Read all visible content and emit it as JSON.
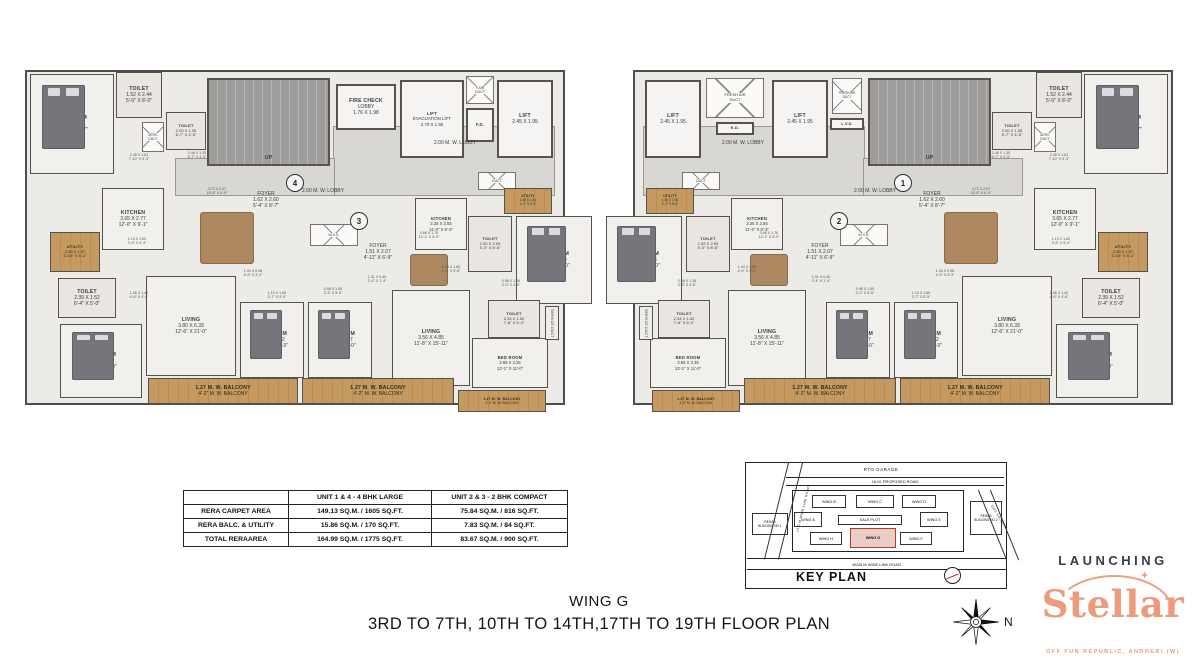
{
  "titles": {
    "wing": "WING G",
    "floors": "3RD TO 7TH, 10TH TO 14TH,17TH TO 19TH FLOOR PLAN"
  },
  "logo": {
    "launching": "LAUNCHING",
    "name": "Stellar",
    "tagline": "OFF FUN REPUBLIC, ANDHERI (W)",
    "sparkle_icon": "✦",
    "accent_color": "#ec9b7d",
    "dark_color": "#363c4a"
  },
  "compass": {
    "label": "N"
  },
  "area_table": {
    "headers": [
      "",
      "UNIT 1 & 4 - 4 BHK LARGE",
      "UNIT 2 & 3 - 2 BHK COMPACT"
    ],
    "rows": [
      [
        "RERA CARPET AREA",
        "149.13 SQ.M. / 1605 SQ.FT.",
        "75.84 SQ.M. / 816 SQ.FT."
      ],
      [
        "RERA BALC. & UTILITY",
        "15.86 SQ.M. / 170 SQ.FT.",
        "7.83 SQ.M. / 84 SQ.FT."
      ],
      [
        "TOTAL RERAAREA",
        "164.99 SQ.M. / 1775 SQ.FT.",
        "83.67 SQ.M. / 900 SQ.FT."
      ]
    ]
  },
  "plan": {
    "canvas": {
      "w": 1198,
      "h": 666
    },
    "wall_color": "#514d49",
    "rooms": [
      {
        "n": "floor-slab",
        "t": "base",
        "x": 25,
        "y": 70,
        "w": 540,
        "h": 335,
        "m": true
      },
      {
        "n": "lobby-corridor",
        "t": "lobby",
        "x": 333,
        "y": 126,
        "w": 222,
        "h": 70,
        "m": true
      },
      {
        "n": "lobby-corridor",
        "t": "lobby",
        "x": 175,
        "y": 158,
        "w": 160,
        "h": 38,
        "m": true
      },
      {
        "n": "staircase",
        "t": "stair",
        "x": 207,
        "y": 78,
        "w": 123,
        "h": 88,
        "l": [
          "UP"
        ],
        "m": true
      },
      {
        "n": "fire-check-lobby",
        "t": "lift",
        "x": 336,
        "y": 84,
        "w": 60,
        "h": 46,
        "l": [
          "FIRE CHECK",
          "LOBBY",
          "1.76 X 1.98"
        ]
      },
      {
        "n": "evacuation-lift",
        "t": "lift",
        "x": 400,
        "y": 80,
        "w": 64,
        "h": 78,
        "l": [
          "LIFT",
          "EVACUATION LIFT",
          "2.70 X 1.95"
        ],
        "fs": 4.4
      },
      {
        "n": "fresh-air-duct",
        "t": "cross",
        "x": 466,
        "y": 76,
        "w": 28,
        "h": 28,
        "l": [
          "F.AIR",
          "DUCT"
        ],
        "fs": 3.5
      },
      {
        "n": "fire-duct",
        "t": "lift",
        "x": 466,
        "y": 108,
        "w": 28,
        "h": 34,
        "l": [
          "F.D."
        ],
        "fs": 4.2
      },
      {
        "n": "lift",
        "t": "lift",
        "x": 497,
        "y": 80,
        "w": 56,
        "h": 78,
        "l": [
          "LIFT",
          "2.45 X 1.95"
        ]
      },
      {
        "n": "lift",
        "t": "lift",
        "x": 645,
        "y": 80,
        "w": 56,
        "h": 78,
        "l": [
          "LIFT",
          "2.45 X 1.95"
        ]
      },
      {
        "n": "fresh-air-duct",
        "t": "cross",
        "x": 706,
        "y": 78,
        "w": 58,
        "h": 40,
        "l": [
          "FRESH AIR",
          "DUCT"
        ],
        "fs": 4
      },
      {
        "n": "electrical-duct",
        "t": "lift",
        "x": 716,
        "y": 122,
        "w": 38,
        "h": 13,
        "l": [
          "E.D."
        ],
        "fs": 4
      },
      {
        "n": "lift",
        "t": "lift",
        "x": 772,
        "y": 80,
        "w": 56,
        "h": 78,
        "l": [
          "LIFT",
          "2.45 X 1.95"
        ]
      },
      {
        "n": "fresh-air-duct",
        "t": "cross",
        "x": 832,
        "y": 78,
        "w": 30,
        "h": 36,
        "l": [
          "FRESH AIR",
          "DUCT"
        ],
        "fs": 3.2
      },
      {
        "n": "lv-duct",
        "t": "lift",
        "x": 830,
        "y": 118,
        "w": 34,
        "h": 12,
        "l": [
          "L.V.D."
        ],
        "fs": 3.8
      },
      {
        "n": "lobby-label",
        "t": "label",
        "x": 400,
        "y": 138,
        "w": 110,
        "h": 10,
        "l": [
          "2.00 M. W. LOBBY"
        ],
        "m": true
      },
      {
        "n": "lobby-label",
        "t": "label",
        "x": 268,
        "y": 186,
        "w": 110,
        "h": 10,
        "l": [
          "2.00 M. W. LOBBY"
        ],
        "m": true
      },
      {
        "n": "bedroom",
        "t": "unit",
        "x": 30,
        "y": 74,
        "w": 84,
        "h": 100,
        "l": [
          "BED ROOM",
          "3.71 X 4.15",
          "12'-2\" X 13'-7\""
        ],
        "bed": true,
        "m": true
      },
      {
        "n": "toilet",
        "t": "toilet",
        "x": 116,
        "y": 72,
        "w": 46,
        "h": 46,
        "l": [
          "TOILET",
          "1.52 X 2.44",
          "5'-0\" X 8'-0\""
        ],
        "m": true
      },
      {
        "n": "service-duct",
        "t": "cross",
        "x": 142,
        "y": 122,
        "w": 22,
        "h": 30,
        "l": [
          "SERV.",
          "DUCT"
        ],
        "fs": 3.4,
        "m": true
      },
      {
        "n": "toilet",
        "t": "toilet",
        "x": 166,
        "y": 112,
        "w": 40,
        "h": 38,
        "l": [
          "TOILET",
          "2.00 X 1.35",
          "6'-7\" X 4'-5\""
        ],
        "fs": 4,
        "m": true
      },
      {
        "n": "kitchen",
        "t": "unit",
        "x": 102,
        "y": 188,
        "w": 62,
        "h": 62,
        "l": [
          "KITCHEN",
          "3.65 X 2.77",
          "12'-0\" X 9'-1\""
        ],
        "m": true
      },
      {
        "n": "utility",
        "t": "wood",
        "x": 50,
        "y": 232,
        "w": 50,
        "h": 40,
        "l": [
          "UTILITY",
          "2.09 X 1.57",
          "6'-10\" X 5'-2\""
        ],
        "fs": 4,
        "m": true
      },
      {
        "n": "toilet",
        "t": "toilet",
        "x": 58,
        "y": 278,
        "w": 58,
        "h": 40,
        "l": [
          "TOILET",
          "2.39 X 1.52",
          "6'-4\" X 5'-0\""
        ],
        "m": true
      },
      {
        "n": "bedroom",
        "t": "unit",
        "x": 60,
        "y": 324,
        "w": 82,
        "h": 74,
        "l": [
          "BED ROOM",
          "3.59 X 4.27",
          "11'-9\" X 14'-0\""
        ],
        "bed": true,
        "m": true
      },
      {
        "n": "living-room",
        "t": "unit",
        "x": 146,
        "y": 276,
        "w": 90,
        "h": 100,
        "l": [
          "LIVING",
          "3.80 X 6.39",
          "12'-6\" X 21'-0\""
        ],
        "m": true
      },
      {
        "n": "bedroom",
        "t": "unit",
        "x": 240,
        "y": 302,
        "w": 64,
        "h": 76,
        "l": [
          "BED ROOM",
          "3.17 X 3.12",
          "10'-5\" X 10'-3\""
        ],
        "bed": true,
        "m": true
      },
      {
        "n": "bedroom",
        "t": "unit",
        "x": 308,
        "y": 302,
        "w": 64,
        "h": 76,
        "l": [
          "BED ROOM",
          "3.35 X 4.27",
          "11'-0\" X 14'-0\""
        ],
        "bed": true,
        "m": true
      },
      {
        "n": "foyer",
        "t": "label",
        "x": 238,
        "y": 182,
        "w": 56,
        "h": 36,
        "l": [
          "FOYER",
          "1.62 X 2.60",
          "5'-4\" X 8'-7\""
        ],
        "m": true
      },
      {
        "n": "mvs-duct",
        "t": "cross",
        "x": 310,
        "y": 224,
        "w": 48,
        "h": 22,
        "l": [
          "M.V.S."
        ],
        "fs": 3.8,
        "m": true
      },
      {
        "n": "foyer",
        "t": "label",
        "x": 352,
        "y": 234,
        "w": 52,
        "h": 36,
        "l": [
          "FOYER",
          "1.51 X 2.07",
          "4'-11\" X 6'-9\""
        ],
        "m": true
      },
      {
        "n": "kitchen",
        "t": "unit",
        "x": 415,
        "y": 198,
        "w": 52,
        "h": 52,
        "l": [
          "KITCHEN",
          "3.35 X 2.55",
          "11'-0\" X 8'-3\""
        ],
        "fs": 4.2,
        "m": true
      },
      {
        "n": "duct",
        "t": "cross",
        "x": 478,
        "y": 172,
        "w": 38,
        "h": 18,
        "l": [
          "DUCT"
        ],
        "fs": 3.5,
        "m": true
      },
      {
        "n": "utility",
        "t": "wood",
        "x": 504,
        "y": 188,
        "w": 48,
        "h": 26,
        "l": [
          "UTILITY",
          "1.40 X 1.61",
          "4'-7\" X 5'-4\""
        ],
        "fs": 3.2,
        "m": true
      },
      {
        "n": "toilet",
        "t": "toilet",
        "x": 468,
        "y": 216,
        "w": 44,
        "h": 56,
        "l": [
          "TOILET",
          "1.52 X 2.59",
          "5'-0\" X 8'-6\""
        ],
        "fs": 4,
        "m": true
      },
      {
        "n": "bedroom",
        "t": "unit",
        "x": 516,
        "y": 216,
        "w": 76,
        "h": 88,
        "l": [
          "BED ROOM",
          "3.35 X 3.65",
          "11'-0\" X 12'-0\""
        ],
        "bed": true,
        "m": true
      },
      {
        "n": "toilet",
        "t": "toilet",
        "x": 488,
        "y": 300,
        "w": 52,
        "h": 38,
        "l": [
          "TOILET",
          "2.34 X 1.52",
          "7'-8\" X 5'-0\""
        ],
        "fs": 4,
        "m": true
      },
      {
        "n": "living-room",
        "t": "unit",
        "x": 392,
        "y": 290,
        "w": 78,
        "h": 96,
        "l": [
          "LIVING",
          "3.56 X 4.85",
          "11'-8\" X 15'-11\""
        ],
        "m": true
      },
      {
        "n": "bedroom",
        "t": "unit",
        "x": 472,
        "y": 338,
        "w": 76,
        "h": 50,
        "l": [
          "BED ROOM",
          "3.96 X 3.35",
          "13'-1\" X 11'-0\""
        ],
        "fs": 4.2,
        "m": true
      },
      {
        "n": "service-duct",
        "t": "vert",
        "x": 545,
        "y": 306,
        "w": 14,
        "h": 34,
        "l": [
          "SERVICE DUCT"
        ],
        "m": true
      },
      {
        "n": "balcony",
        "t": "wood",
        "x": 148,
        "y": 378,
        "w": 150,
        "h": 26,
        "l": [
          "1.27 M. W. BALCONY",
          "4'-2\" M. W. BALCONY"
        ],
        "m": true
      },
      {
        "n": "balcony",
        "t": "wood",
        "x": 302,
        "y": 378,
        "w": 152,
        "h": 26,
        "l": [
          "1.27 M. W. BALCONY",
          "4'-2\" M. W. BALCONY"
        ],
        "m": true
      },
      {
        "n": "balcony",
        "t": "wood",
        "x": 458,
        "y": 390,
        "w": 88,
        "h": 22,
        "l": [
          "1.27 M. W. BALCONY",
          "4'-2\" M. W. BALCONY"
        ],
        "fs": 3.4,
        "m": true
      },
      {
        "n": "dining-table",
        "t": "table",
        "x": 200,
        "y": 212,
        "w": 54,
        "h": 52,
        "m": true
      },
      {
        "n": "dining-table",
        "t": "table",
        "x": 410,
        "y": 254,
        "w": 38,
        "h": 32,
        "m": true
      },
      {
        "n": "unit-number",
        "t": "circle",
        "x": 286,
        "y": 174,
        "w": 18,
        "h": 18,
        "l": [
          "4"
        ]
      },
      {
        "n": "unit-number",
        "t": "circle",
        "x": 350,
        "y": 212,
        "w": 18,
        "h": 18,
        "l": [
          "3"
        ]
      },
      {
        "n": "unit-number",
        "t": "circle",
        "x": 830,
        "y": 212,
        "w": 18,
        "h": 18,
        "l": [
          "2"
        ]
      },
      {
        "n": "unit-number",
        "t": "circle",
        "x": 894,
        "y": 174,
        "w": 18,
        "h": 18,
        "l": [
          "1"
        ]
      },
      {
        "n": "dim-note",
        "t": "note",
        "x": 118,
        "y": 150,
        "w": 42,
        "h": 14,
        "l": [
          "2.35 X 1.61",
          "7'-10\" X 5'-3\""
        ],
        "m": true
      },
      {
        "n": "dim-note",
        "t": "note",
        "x": 176,
        "y": 148,
        "w": 42,
        "h": 14,
        "l": [
          "2.46 X 1.35",
          "6'-7\" X 4'-5\""
        ],
        "m": true
      },
      {
        "n": "dim-note",
        "t": "note",
        "x": 196,
        "y": 184,
        "w": 42,
        "h": 14,
        "l": [
          "4.72 X 2.07",
          "15'-6\" X 6'-9\""
        ],
        "m": true
      },
      {
        "n": "dim-note",
        "t": "note",
        "x": 408,
        "y": 228,
        "w": 42,
        "h": 14,
        "l": [
          "3.68 X 1.76",
          "12'-1\" X 5'-9\""
        ],
        "m": true
      },
      {
        "n": "dim-note",
        "t": "note",
        "x": 356,
        "y": 272,
        "w": 42,
        "h": 14,
        "l": [
          "1.01 X 0.40",
          "3'-4\" X 1'-4\""
        ],
        "m": true
      },
      {
        "n": "dim-note",
        "t": "note",
        "x": 430,
        "y": 262,
        "w": 42,
        "h": 14,
        "l": [
          "1.44 X 1.65",
          "4'-9\" X 5'-5\""
        ],
        "m": true
      },
      {
        "n": "dim-note",
        "t": "note",
        "x": 490,
        "y": 276,
        "w": 42,
        "h": 14,
        "l": [
          "0.98 X 1.36",
          "3'-3\" X 4'-6\""
        ],
        "m": true
      },
      {
        "n": "dim-note",
        "t": "note",
        "x": 116,
        "y": 234,
        "w": 42,
        "h": 14,
        "l": [
          "1.13 X 1.62",
          "3'-9\" X 5'-4\""
        ],
        "m": true
      },
      {
        "n": "dim-note",
        "t": "note",
        "x": 118,
        "y": 288,
        "w": 42,
        "h": 14,
        "l": [
          "1.36 X 1.42",
          "4'-6\" X 4'-8\""
        ],
        "m": true
      },
      {
        "n": "dim-note",
        "t": "note",
        "x": 232,
        "y": 266,
        "w": 42,
        "h": 14,
        "l": [
          "1.34 X 0.98",
          "4'-5\" X 3'-3\""
        ],
        "m": true
      },
      {
        "n": "dim-note",
        "t": "note",
        "x": 256,
        "y": 288,
        "w": 42,
        "h": 14,
        "l": [
          "1.10 X 1.66",
          "3'-7\" X 5'-5\""
        ],
        "m": true
      },
      {
        "n": "dim-note",
        "t": "note",
        "x": 312,
        "y": 284,
        "w": 42,
        "h": 14,
        "l": [
          "0.98 X 1.65",
          "3'-3\" X 5'-5\""
        ],
        "m": true
      }
    ]
  },
  "key_plan": {
    "els": [
      {
        "n": "kp-rto-garage",
        "t": "text",
        "x": 85,
        "y": 2,
        "w": 100,
        "h": 9,
        "l": [
          "RTO GARAGE"
        ],
        "fs": 4.5
      },
      {
        "n": "kp-proposed-road",
        "t": "roadh",
        "x": 40,
        "y": 14,
        "w": 218,
        "h": 9,
        "l": [
          "16 M. PROPOSED ROAD"
        ]
      },
      {
        "n": "kp-compound",
        "t": "box",
        "x": 46,
        "y": 27,
        "w": 172,
        "h": 62
      },
      {
        "n": "kp-wing-b",
        "t": "wing",
        "x": 66,
        "y": 32,
        "w": 34,
        "h": 13,
        "l": [
          "WING B"
        ]
      },
      {
        "n": "kp-wing-c",
        "t": "wing",
        "x": 110,
        "y": 32,
        "w": 38,
        "h": 13,
        "l": [
          "WING C"
        ]
      },
      {
        "n": "kp-wing-d",
        "t": "wing",
        "x": 156,
        "y": 32,
        "w": 34,
        "h": 13,
        "l": [
          "WING D"
        ]
      },
      {
        "n": "kp-wing-a",
        "t": "wing",
        "x": 48,
        "y": 49,
        "w": 28,
        "h": 15,
        "l": [
          "WING A"
        ]
      },
      {
        "n": "kp-sale-plot",
        "t": "wing",
        "x": 92,
        "y": 52,
        "w": 64,
        "h": 10,
        "l": [
          "SALE PLOT"
        ]
      },
      {
        "n": "kp-wing-e",
        "t": "wing",
        "x": 174,
        "y": 49,
        "w": 28,
        "h": 15,
        "l": [
          "WING E"
        ]
      },
      {
        "n": "kp-wing-h",
        "t": "wing",
        "x": 64,
        "y": 69,
        "w": 32,
        "h": 13,
        "l": [
          "WING H"
        ]
      },
      {
        "n": "kp-wing-g",
        "t": "wingred",
        "x": 104,
        "y": 65,
        "w": 46,
        "h": 20,
        "l": [
          "WING G"
        ]
      },
      {
        "n": "kp-wing-f",
        "t": "wing",
        "x": 154,
        "y": 69,
        "w": 32,
        "h": 13,
        "l": [
          "WING F"
        ]
      },
      {
        "n": "kp-rehab-building-1",
        "t": "wing",
        "x": 6,
        "y": 50,
        "w": 36,
        "h": 22,
        "l": [
          "REHAB",
          "BUILDING NO.1"
        ],
        "fs": 3.2
      },
      {
        "n": "kp-rehab-building-2",
        "t": "wing",
        "x": 224,
        "y": 38,
        "w": 32,
        "h": 34,
        "l": [
          "REHAB",
          "BUILDING NO.2"
        ],
        "fs": 3.2
      },
      {
        "n": "kp-link-road",
        "t": "roadh",
        "x": 1,
        "y": 95,
        "w": 259,
        "h": 12,
        "l": [
          "36/45 M WIDE LINK ROAD"
        ]
      },
      {
        "n": "kp-road-line",
        "t": "line",
        "x": 30,
        "y": -2,
        "w": 1,
        "h": 100,
        "deg": 14
      },
      {
        "n": "kp-road-line",
        "t": "line",
        "x": 44,
        "y": -2,
        "w": 1,
        "h": 100,
        "deg": 14
      },
      {
        "n": "kp-road-line",
        "t": "line",
        "x": 246,
        "y": 24,
        "w": 1,
        "h": 76,
        "deg": -22
      },
      {
        "n": "kp-road-line",
        "t": "line",
        "x": 258,
        "y": 24,
        "w": 1,
        "h": 76,
        "deg": -22
      },
      {
        "n": "kp-left-road-label",
        "t": "rot",
        "x": 22,
        "y": 42,
        "w": 70,
        "h": 8,
        "l": [
          "13.3 M WIDE LINE ROAD"
        ],
        "fs": 3.2,
        "deg": -76
      },
      {
        "n": "kp-right-road-label",
        "t": "rot",
        "x": 228,
        "y": 50,
        "w": 50,
        "h": 8,
        "l": [
          "DGS SOCIETY"
        ],
        "fs": 3.2,
        "deg": 58
      },
      {
        "n": "kp-title",
        "t": "bigtext",
        "x": 50,
        "y": 104,
        "w": 110,
        "h": 20,
        "l": [
          "KEY PLAN"
        ]
      },
      {
        "n": "kp-compass",
        "t": "kpcompass",
        "x": 198,
        "y": 104,
        "w": 17,
        "h": 17
      }
    ]
  }
}
